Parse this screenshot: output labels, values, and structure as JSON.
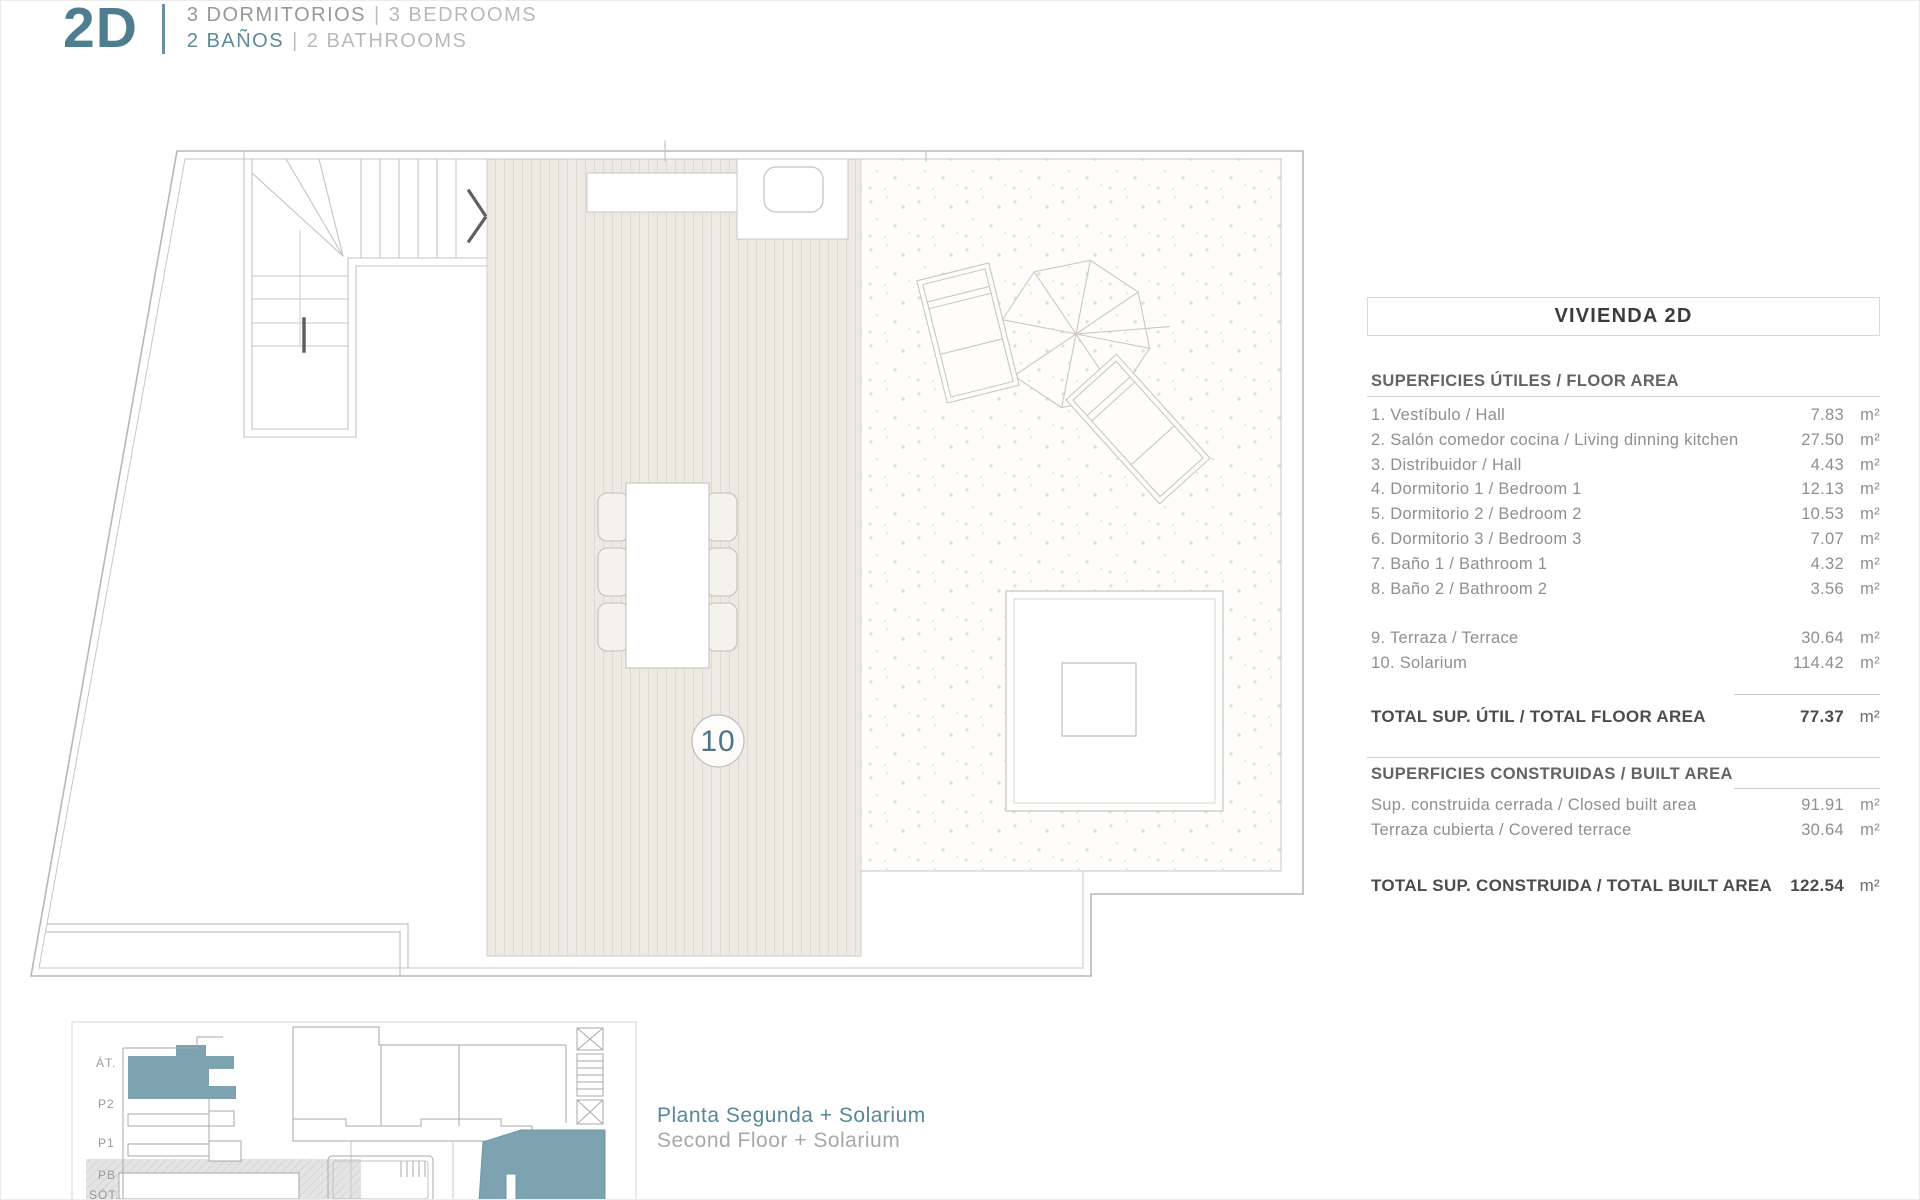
{
  "header": {
    "logo": "2D",
    "bedrooms_es": "3 DORMITORIOS",
    "bedrooms_en": "3 BEDROOMS",
    "bathrooms_es": "2 BAÑOS",
    "bathrooms_en": "2 BATHROOMS",
    "separator": "|"
  },
  "plan": {
    "unit_number": "10"
  },
  "area_table": {
    "title": "VIVIENDA 2D",
    "floor_area": {
      "header": "SUPERFICIES ÚTILES / FLOOR AREA",
      "rows": [
        {
          "label": "1. Vestíbulo / Hall",
          "value": "7.83",
          "unit": "m²"
        },
        {
          "label": "2. Salón comedor cocina / Living dinning kitchen",
          "value": "27.50",
          "unit": "m²"
        },
        {
          "label": "3. Distribuidor / Hall",
          "value": "4.43",
          "unit": "m²"
        },
        {
          "label": "4. Dormitorio 1 / Bedroom 1",
          "value": "12.13",
          "unit": "m²"
        },
        {
          "label": "5. Dormitorio 2 / Bedroom 2",
          "value": "10.53",
          "unit": "m²"
        },
        {
          "label": "6. Dormitorio 3 / Bedroom 3",
          "value": "7.07",
          "unit": "m²"
        },
        {
          "label": "7. Baño 1 / Bathroom 1",
          "value": "4.32",
          "unit": "m²"
        },
        {
          "label": "8. Baño 2 / Bathroom 2",
          "value": "3.56",
          "unit": "m²"
        }
      ],
      "outdoor_rows": [
        {
          "label": "9. Terraza / Terrace",
          "value": "30.64",
          "unit": "m²"
        },
        {
          "label": "10. Solarium",
          "value": "114.42",
          "unit": "m²"
        }
      ],
      "total_label": "TOTAL SUP. ÚTIL / TOTAL FLOOR AREA",
      "total_value": "77.37",
      "total_unit": "m²"
    },
    "built_area": {
      "header": "SUPERFICIES CONSTRUIDAS / BUILT AREA",
      "rows": [
        {
          "label": "Sup. construida cerrada / Closed built area",
          "value": "91.91",
          "unit": "m²"
        },
        {
          "label": "Terraza cubierta / Covered terrace",
          "value": "30.64",
          "unit": "m²"
        }
      ],
      "total_label": "TOTAL SUP. CONSTRUIDA /  TOTAL BUILT AREA",
      "total_value": "122.54",
      "total_unit": "m²"
    }
  },
  "key_diagrams": {
    "floors": [
      "ÁT.",
      "P2",
      "P1",
      "PB",
      "SÓT."
    ],
    "caption_es": "Planta Segunda + Solarium",
    "caption_en": "Second Floor + Solarium"
  },
  "colors": {
    "accent_teal": "#4e7d8f",
    "highlight_teal": "#7da2b0",
    "text_gray": "#8f8f8f",
    "text_light_gray": "#b9b9b9",
    "text_dark": "#4f4f4f"
  }
}
